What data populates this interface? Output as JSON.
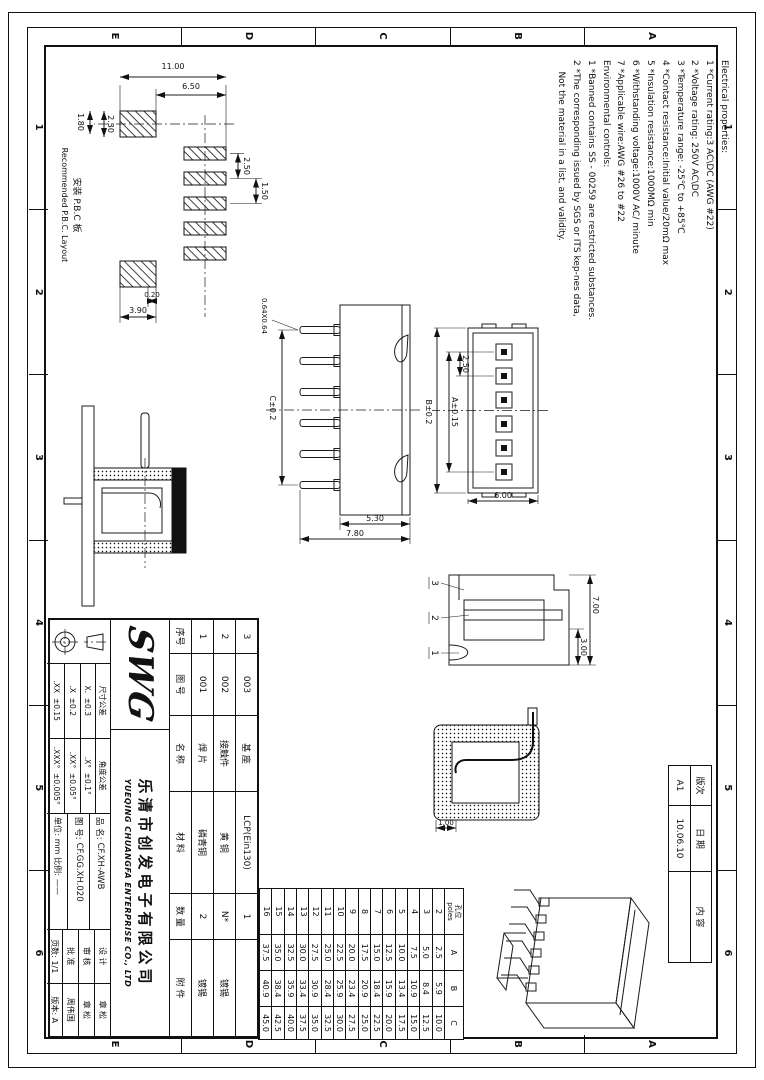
{
  "zones": {
    "columns": [
      "1",
      "2",
      "3",
      "4",
      "5",
      "6"
    ],
    "rows": [
      "A",
      "B",
      "C",
      "D",
      "E"
    ]
  },
  "notes": {
    "lines": [
      "Electrical properties:",
      "1 *Current rating:3 AC\\DC (AWG #22)",
      "2 *Voltage rating: 250V AC\\DC",
      "3 *Temperature range: -25℃ to +85℃",
      "4 *Contact resistance:Initial value/20mΩ max",
      "5 *Insulation resistance:1000MΩ min",
      "6 *Withstanding voltage:1000V AC/ minute",
      "7 *Applicable wire:AWG #26 to #22",
      "Environmental controls:",
      "1 *Banned contains SS - 00259 are restricted substances.",
      "2 *The corresponding issued by SGS or ITS kep-nes data,",
      "    Not the material in a list, and validity."
    ]
  },
  "revision": {
    "col_rev": "版次",
    "col_date": "日 期",
    "col_content": "内 容",
    "rev": "A1",
    "date": "10.06.10",
    "content": ""
  },
  "bom": {
    "headers": {
      "no": "序号",
      "dwg": "图 号",
      "name": "名 称",
      "material": "材 料",
      "qty": "数 量",
      "finish": "附 件"
    },
    "rows": [
      {
        "no": "3",
        "dwg": "003",
        "name": "基 座",
        "material": "LCP(Ein130)",
        "qty": "1",
        "finish": ""
      },
      {
        "no": "2",
        "dwg": "002",
        "name": "接触件",
        "material": "黄 铜",
        "qty": "N*",
        "finish": "镀锡"
      },
      {
        "no": "1",
        "dwg": "001",
        "name": "焊 片",
        "material": "磷青铜",
        "qty": "2",
        "finish": "镀锡"
      }
    ]
  },
  "company": {
    "logo": "SWG",
    "name_cn": "乐清市创发电子有限公司",
    "name_en": "YUEQING CHUANGFA ENTERPRISE CO., LTD"
  },
  "title_block": {
    "part_label": "品 名:",
    "part_value": "CF.XH-AWB",
    "dwg_label": "图 号:",
    "dwg_value": "CF.GG.XH.020",
    "unit_label": "单位:",
    "unit_value": "mm",
    "scale_label": "比例:",
    "scale_value": "——",
    "pages_label": "页数:",
    "pages_value": "1/1",
    "version_label": "版本:",
    "version_value": "A",
    "design_label": "设 计",
    "design_value": "章 松",
    "check_label": "审 核",
    "check_value": "章 松",
    "approve_label": "批 准",
    "approve_value": "周伟国",
    "tol_size_header": "尺寸公差",
    "tol_angle_header": "角度公差",
    "tol_rows": [
      {
        "size": "X.  ±0.3",
        "angle": ".X°  ±0.1°"
      },
      {
        "size": ".X  ±0.2",
        "angle": ".XX°  ±0.05°"
      },
      {
        "size": ".XX  ±0.15",
        "angle": ".XXX°  ±0.005°"
      }
    ]
  },
  "poles_table": {
    "header_cn": "孔位",
    "header_en": "poles",
    "col_a": "A",
    "col_b": "B",
    "col_c": "C",
    "rows": [
      [
        "2",
        "2.5",
        "5.9",
        "10.0"
      ],
      [
        "3",
        "5.0",
        "8.4",
        "12.5"
      ],
      [
        "4",
        "7.5",
        "10.9",
        "15.0"
      ],
      [
        "5",
        "10.0",
        "13.4",
        "17.5"
      ],
      [
        "6",
        "12.5",
        "15.9",
        "20.0"
      ],
      [
        "7",
        "15.0",
        "18.4",
        "22.5"
      ],
      [
        "8",
        "17.5",
        "20.9",
        "25.0"
      ],
      [
        "9",
        "20.0",
        "23.4",
        "27.5"
      ],
      [
        "10",
        "22.5",
        "25.9",
        "30.0"
      ],
      [
        "11",
        "25.0",
        "28.4",
        "32.5"
      ],
      [
        "12",
        "27.5",
        "30.9",
        "35.0"
      ],
      [
        "13",
        "30.0",
        "33.4",
        "37.5"
      ],
      [
        "14",
        "32.5",
        "35.9",
        "40.0"
      ],
      [
        "15",
        "35.0",
        "38.4",
        "42.5"
      ],
      [
        "16",
        "37.5",
        "40.9",
        "45.0"
      ]
    ]
  },
  "views": {
    "pcb": {
      "label_cn": "安装 P.B.C 板",
      "label_en": "Recommended P.B.C. Layout",
      "d_overall": "11.00",
      "d_inner": "6.50",
      "d_pitch": "2.50",
      "d_gap": "1.50",
      "d_pad1": "2.30",
      "d_pad2": "1.80",
      "d_off": "0.20",
      "d_big": "3.90"
    },
    "front": {
      "pitch": "2.50",
      "span_a": "A±0.15",
      "span_b": "B±0.2",
      "height": "6.00"
    },
    "side": {
      "body_h": "5.30",
      "total_h": "7.80",
      "pin_size": "0.64X0.64",
      "span_c": "C±0.2"
    },
    "section": {
      "d_small": "3.00",
      "d_large": "7.00",
      "balloon_3": "3",
      "balloon_2": "2",
      "balloon_1": "1"
    },
    "detail": {
      "d1": "1.00"
    }
  }
}
